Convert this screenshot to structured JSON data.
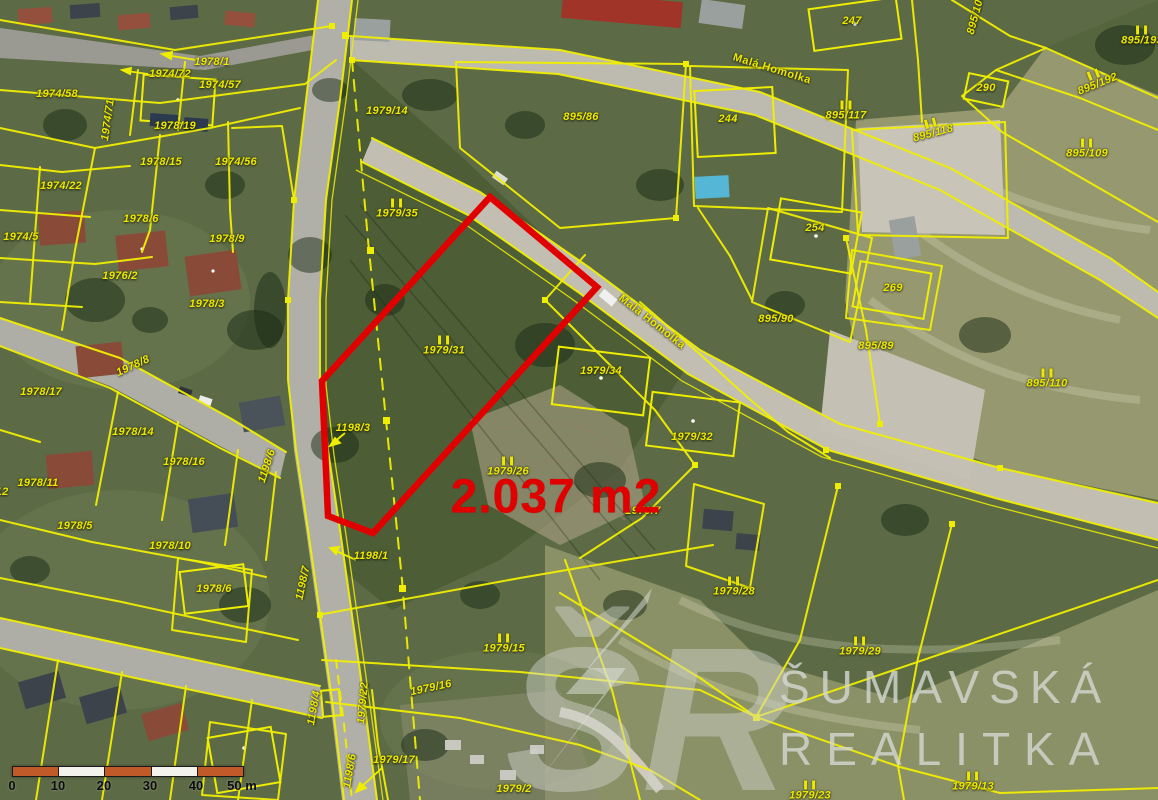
{
  "map": {
    "highlight": {
      "area_label": "2.037 m2",
      "outline_color": "#e10000"
    },
    "watermark": {
      "logo": "ŠR",
      "line1": "ŠUMAVSKÁ",
      "line2": "REALITKA"
    },
    "scale_bar": {
      "labels": [
        "0",
        "10",
        "20",
        "30",
        "40",
        "50 m"
      ]
    },
    "colors": {
      "parcel_line": "#f0ee00",
      "label_text": "#ece800",
      "highlight": "#e10000"
    },
    "labels": [
      {
        "text": "1978/1",
        "x": 212,
        "y": 62
      },
      {
        "text": "1974/72",
        "x": 170,
        "y": 74
      },
      {
        "text": "1974/57",
        "x": 220,
        "y": 85
      },
      {
        "text": "1974/58",
        "x": 57,
        "y": 94
      },
      {
        "text": "1974/71",
        "x": 108,
        "y": 120,
        "rot": -82
      },
      {
        "text": "1978/19",
        "x": 175,
        "y": 126
      },
      {
        "text": "1978/15",
        "x": 161,
        "y": 162
      },
      {
        "text": "1974/56",
        "x": 236,
        "y": 162
      },
      {
        "text": "1974/22",
        "x": 61,
        "y": 186
      },
      {
        "text": "1978/6",
        "x": 141,
        "y": 219
      },
      {
        "text": "1974/5",
        "x": 21,
        "y": 237
      },
      {
        "text": "1978/9",
        "x": 227,
        "y": 239
      },
      {
        "text": "1976/2",
        "x": 120,
        "y": 276
      },
      {
        "text": "1978/3",
        "x": 207,
        "y": 304
      },
      {
        "text": "1978/8",
        "x": 133,
        "y": 366,
        "rot": -25
      },
      {
        "text": "1978/17",
        "x": 41,
        "y": 392
      },
      {
        "text": "1978/14",
        "x": 133,
        "y": 432
      },
      {
        "text": "1978/11",
        "x": 38,
        "y": 483
      },
      {
        "text": "1978/16",
        "x": 184,
        "y": 462
      },
      {
        "text": "1978/5",
        "x": 75,
        "y": 526
      },
      {
        "text": "1978/10",
        "x": 170,
        "y": 546
      },
      {
        "text": "1197/12",
        "x": -12,
        "y": 492
      },
      {
        "text": "1978/6",
        "x": 214,
        "y": 589
      },
      {
        "text": "1198/7",
        "x": 303,
        "y": 583,
        "rot": -78
      },
      {
        "text": "1198/6",
        "x": 267,
        "y": 466,
        "rot": -72
      },
      {
        "text": "1198/3",
        "x": 353,
        "y": 428
      },
      {
        "text": "1198/1",
        "x": 371,
        "y": 556
      },
      {
        "text": "1198/4",
        "x": 314,
        "y": 708,
        "rot": -80
      },
      {
        "text": "1198/6",
        "x": 350,
        "y": 771,
        "rot": -80
      },
      {
        "text": "1979/22",
        "x": 363,
        "y": 703,
        "rot": -85
      },
      {
        "text": "1979/14",
        "x": 387,
        "y": 111
      },
      {
        "text": "1979/35",
        "x": 397,
        "y": 209,
        "ii": true
      },
      {
        "text": "1979/31",
        "x": 444,
        "y": 346,
        "ii": true
      },
      {
        "text": "1979/26",
        "x": 508,
        "y": 467,
        "ii": true
      },
      {
        "text": "1979/15",
        "x": 504,
        "y": 644,
        "ii": true
      },
      {
        "text": "1979/16",
        "x": 431,
        "y": 688,
        "rot": -12
      },
      {
        "text": "1979/17",
        "x": 394,
        "y": 760
      },
      {
        "text": "1979/2",
        "x": 514,
        "y": 789
      },
      {
        "text": "1979/29",
        "x": 860,
        "y": 647,
        "ii": true
      },
      {
        "text": "1979/28",
        "x": 734,
        "y": 587,
        "ii": true
      },
      {
        "text": "1979/23",
        "x": 810,
        "y": 791,
        "ii": true
      },
      {
        "text": "1979/13",
        "x": 973,
        "y": 782,
        "ii": true
      },
      {
        "text": "1979/34",
        "x": 601,
        "y": 371
      },
      {
        "text": "1979/32",
        "x": 692,
        "y": 437
      },
      {
        "text": "1979/7",
        "x": 643,
        "y": 511
      },
      {
        "text": "895/86",
        "x": 581,
        "y": 117
      },
      {
        "text": "244",
        "x": 728,
        "y": 119
      },
      {
        "text": "247",
        "x": 852,
        "y": 21
      },
      {
        "text": "290",
        "x": 986,
        "y": 88
      },
      {
        "text": "254",
        "x": 815,
        "y": 228
      },
      {
        "text": "269",
        "x": 893,
        "y": 288
      },
      {
        "text": "895/90",
        "x": 776,
        "y": 319
      },
      {
        "text": "895/89",
        "x": 876,
        "y": 346
      },
      {
        "text": "895/110",
        "x": 1047,
        "y": 379,
        "ii": true
      },
      {
        "text": "895/109",
        "x": 1087,
        "y": 149,
        "ii": true
      },
      {
        "text": "895/192",
        "x": 1096,
        "y": 80,
        "rot": -22,
        "ii": true
      },
      {
        "text": "895/193",
        "x": 1142,
        "y": 36,
        "ii": true
      },
      {
        "text": "895/117",
        "x": 846,
        "y": 111,
        "ii": true
      },
      {
        "text": "895/118",
        "x": 932,
        "y": 129,
        "rot": -15,
        "ii": true
      },
      {
        "text": "895/106",
        "x": 976,
        "y": 14,
        "rot": -75
      },
      {
        "text": "Malá Homolka",
        "x": 772,
        "y": 69,
        "rot": 17,
        "cls": "street"
      },
      {
        "text": "Malá Homolka",
        "x": 652,
        "y": 322,
        "rot": 38,
        "cls": "street"
      }
    ]
  }
}
